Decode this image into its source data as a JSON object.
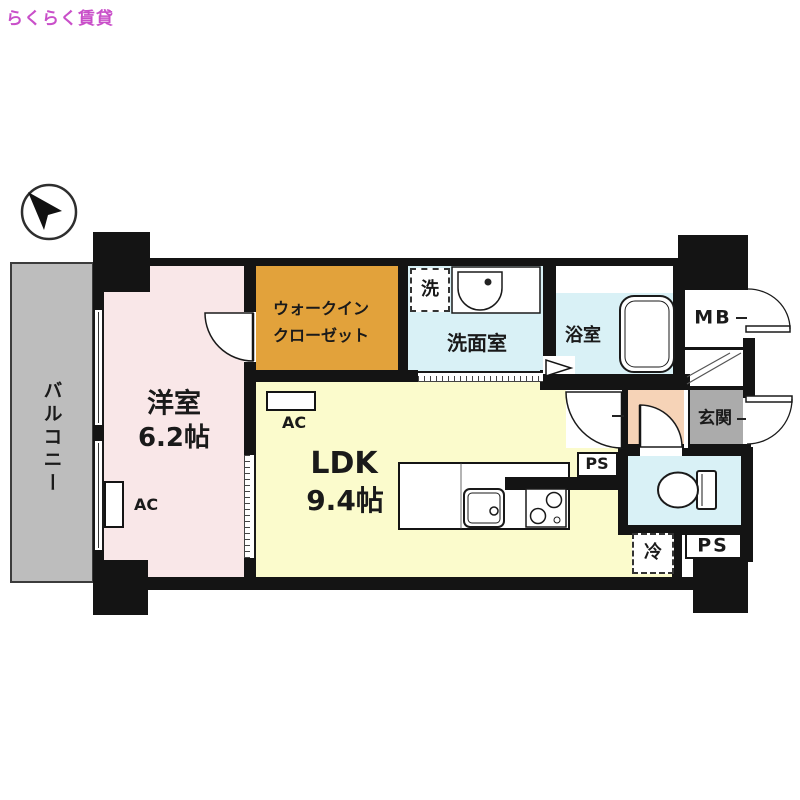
{
  "labels": {
    "logo": "らくらく賃貸",
    "balcony": "バルコニー",
    "western_room": "洋室",
    "western_room_size": "6.2帖",
    "wic_line1": "ウォークイン",
    "wic_line2": "クローゼット",
    "washer": "洗",
    "washroom": "洗面室",
    "bathroom": "浴室",
    "meter_box": "MB",
    "entrance": "玄関",
    "ldk": "LDK",
    "ldk_size": "9.4帖",
    "ac": "AC",
    "ps": "PS",
    "fridge": "冷"
  },
  "colors": {
    "logo": "#c94fc9",
    "wall": "#141414",
    "western_room": "#f9e7e8",
    "walk_in_closet": "#e2a23b",
    "ldk": "#fbfbcc",
    "wet_rooms": "#d9f1f6",
    "entrance_hall": "#f6d3b7",
    "entrance": "#ababab",
    "balcony": "#bdbdbd"
  },
  "compass": {
    "direction": "north-west"
  }
}
